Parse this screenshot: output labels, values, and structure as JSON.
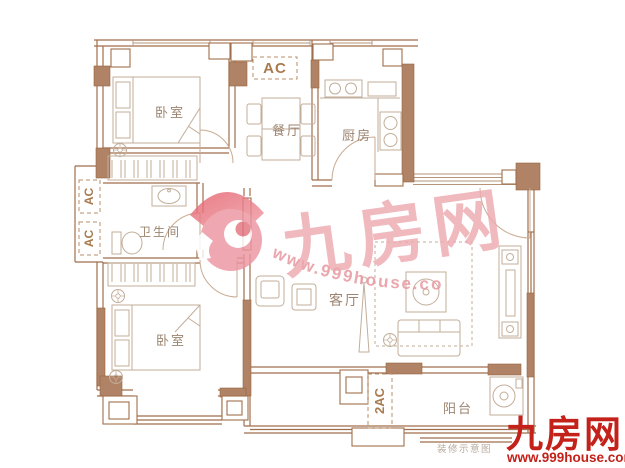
{
  "meta": {
    "type": "apartment-floor-plan",
    "language": "zh-CN"
  },
  "colors": {
    "wall_line": "#a06e4c",
    "wall_fill": "#b08366",
    "furniture_line": "#c2ae9a",
    "room_label": "#9c8470",
    "ac_label": "#a97a4e",
    "watermark_pink": "#ecaab0",
    "watermark_url_pink": "#e7949d",
    "logo_red_dark": "#d95862",
    "logo_red_light": "#ef9ba4",
    "brand_red": "#c32119",
    "caption_gray": "#b9ab9d"
  },
  "rooms": [
    {
      "id": "bedroom-top",
      "label": "卧室"
    },
    {
      "id": "dining",
      "label": "餐厅"
    },
    {
      "id": "kitchen",
      "label": "厨房"
    },
    {
      "id": "bathroom",
      "label": "卫生间"
    },
    {
      "id": "bedroom-bottom",
      "label": "卧室"
    },
    {
      "id": "living",
      "label": "客厅"
    },
    {
      "id": "balcony",
      "label": "阳台"
    }
  ],
  "ac_labels": {
    "top": "AC",
    "left_upper": "AC",
    "left_lower": "AC",
    "balcony": "2AC"
  },
  "watermark": {
    "site_name": "九房网",
    "url": "www.999house.com"
  },
  "brand": {
    "name": "九房网",
    "url": "www.999house.com"
  },
  "caption": "装修示意图"
}
